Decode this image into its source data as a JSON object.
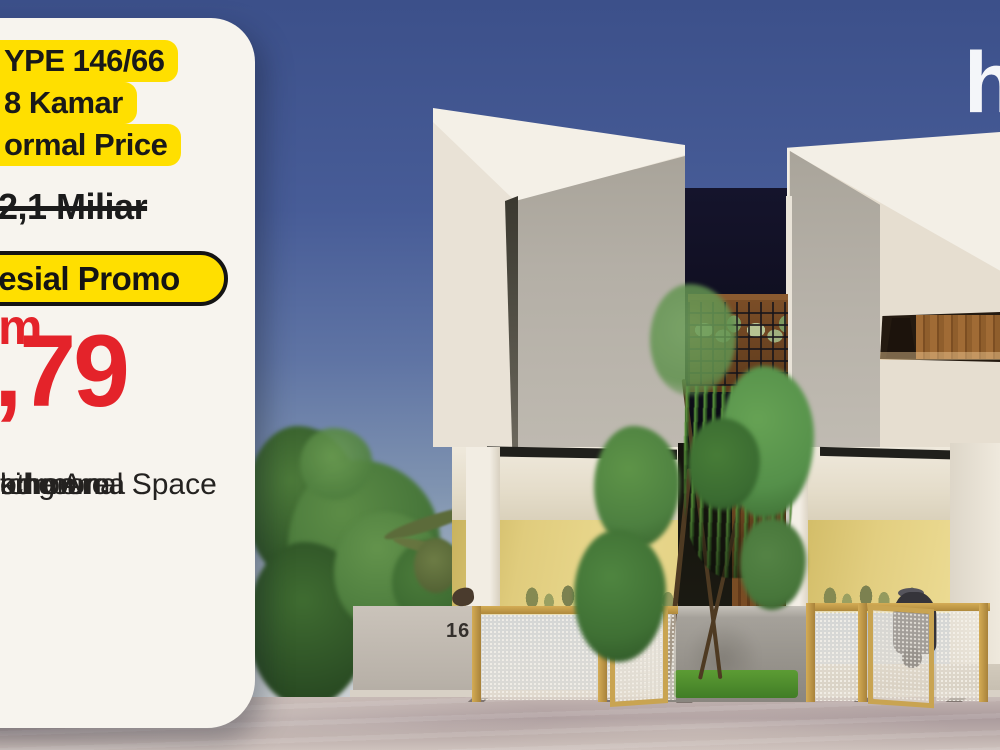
{
  "card": {
    "type_badge_lines": [
      "YPE 146/66",
      "8 Kamar",
      "ormal Price"
    ],
    "old_price": "2,1 Miliar",
    "promo_label": "esial Promo",
    "price": {
      "amount": ",79",
      "unit": "m"
    },
    "features": [
      "edroom",
      "athroom",
      "tchen",
      "ommunal Space",
      "king Area"
    ]
  },
  "scene": {
    "house_number": "16",
    "logo_text": "h"
  },
  "colors": {
    "highlight_yellow": "#ffdf00",
    "promo_pill_yellow": "#ffdf00",
    "price_red": "#e4232a",
    "card_background": "#f7f4ee",
    "sky_top": "#3c508a",
    "sky_horizon": "#d3d6d7",
    "gate_gold": "#c9a451",
    "carport_wall_yellow": "#e0cc7d",
    "logo_white": "#f4f6f9"
  }
}
